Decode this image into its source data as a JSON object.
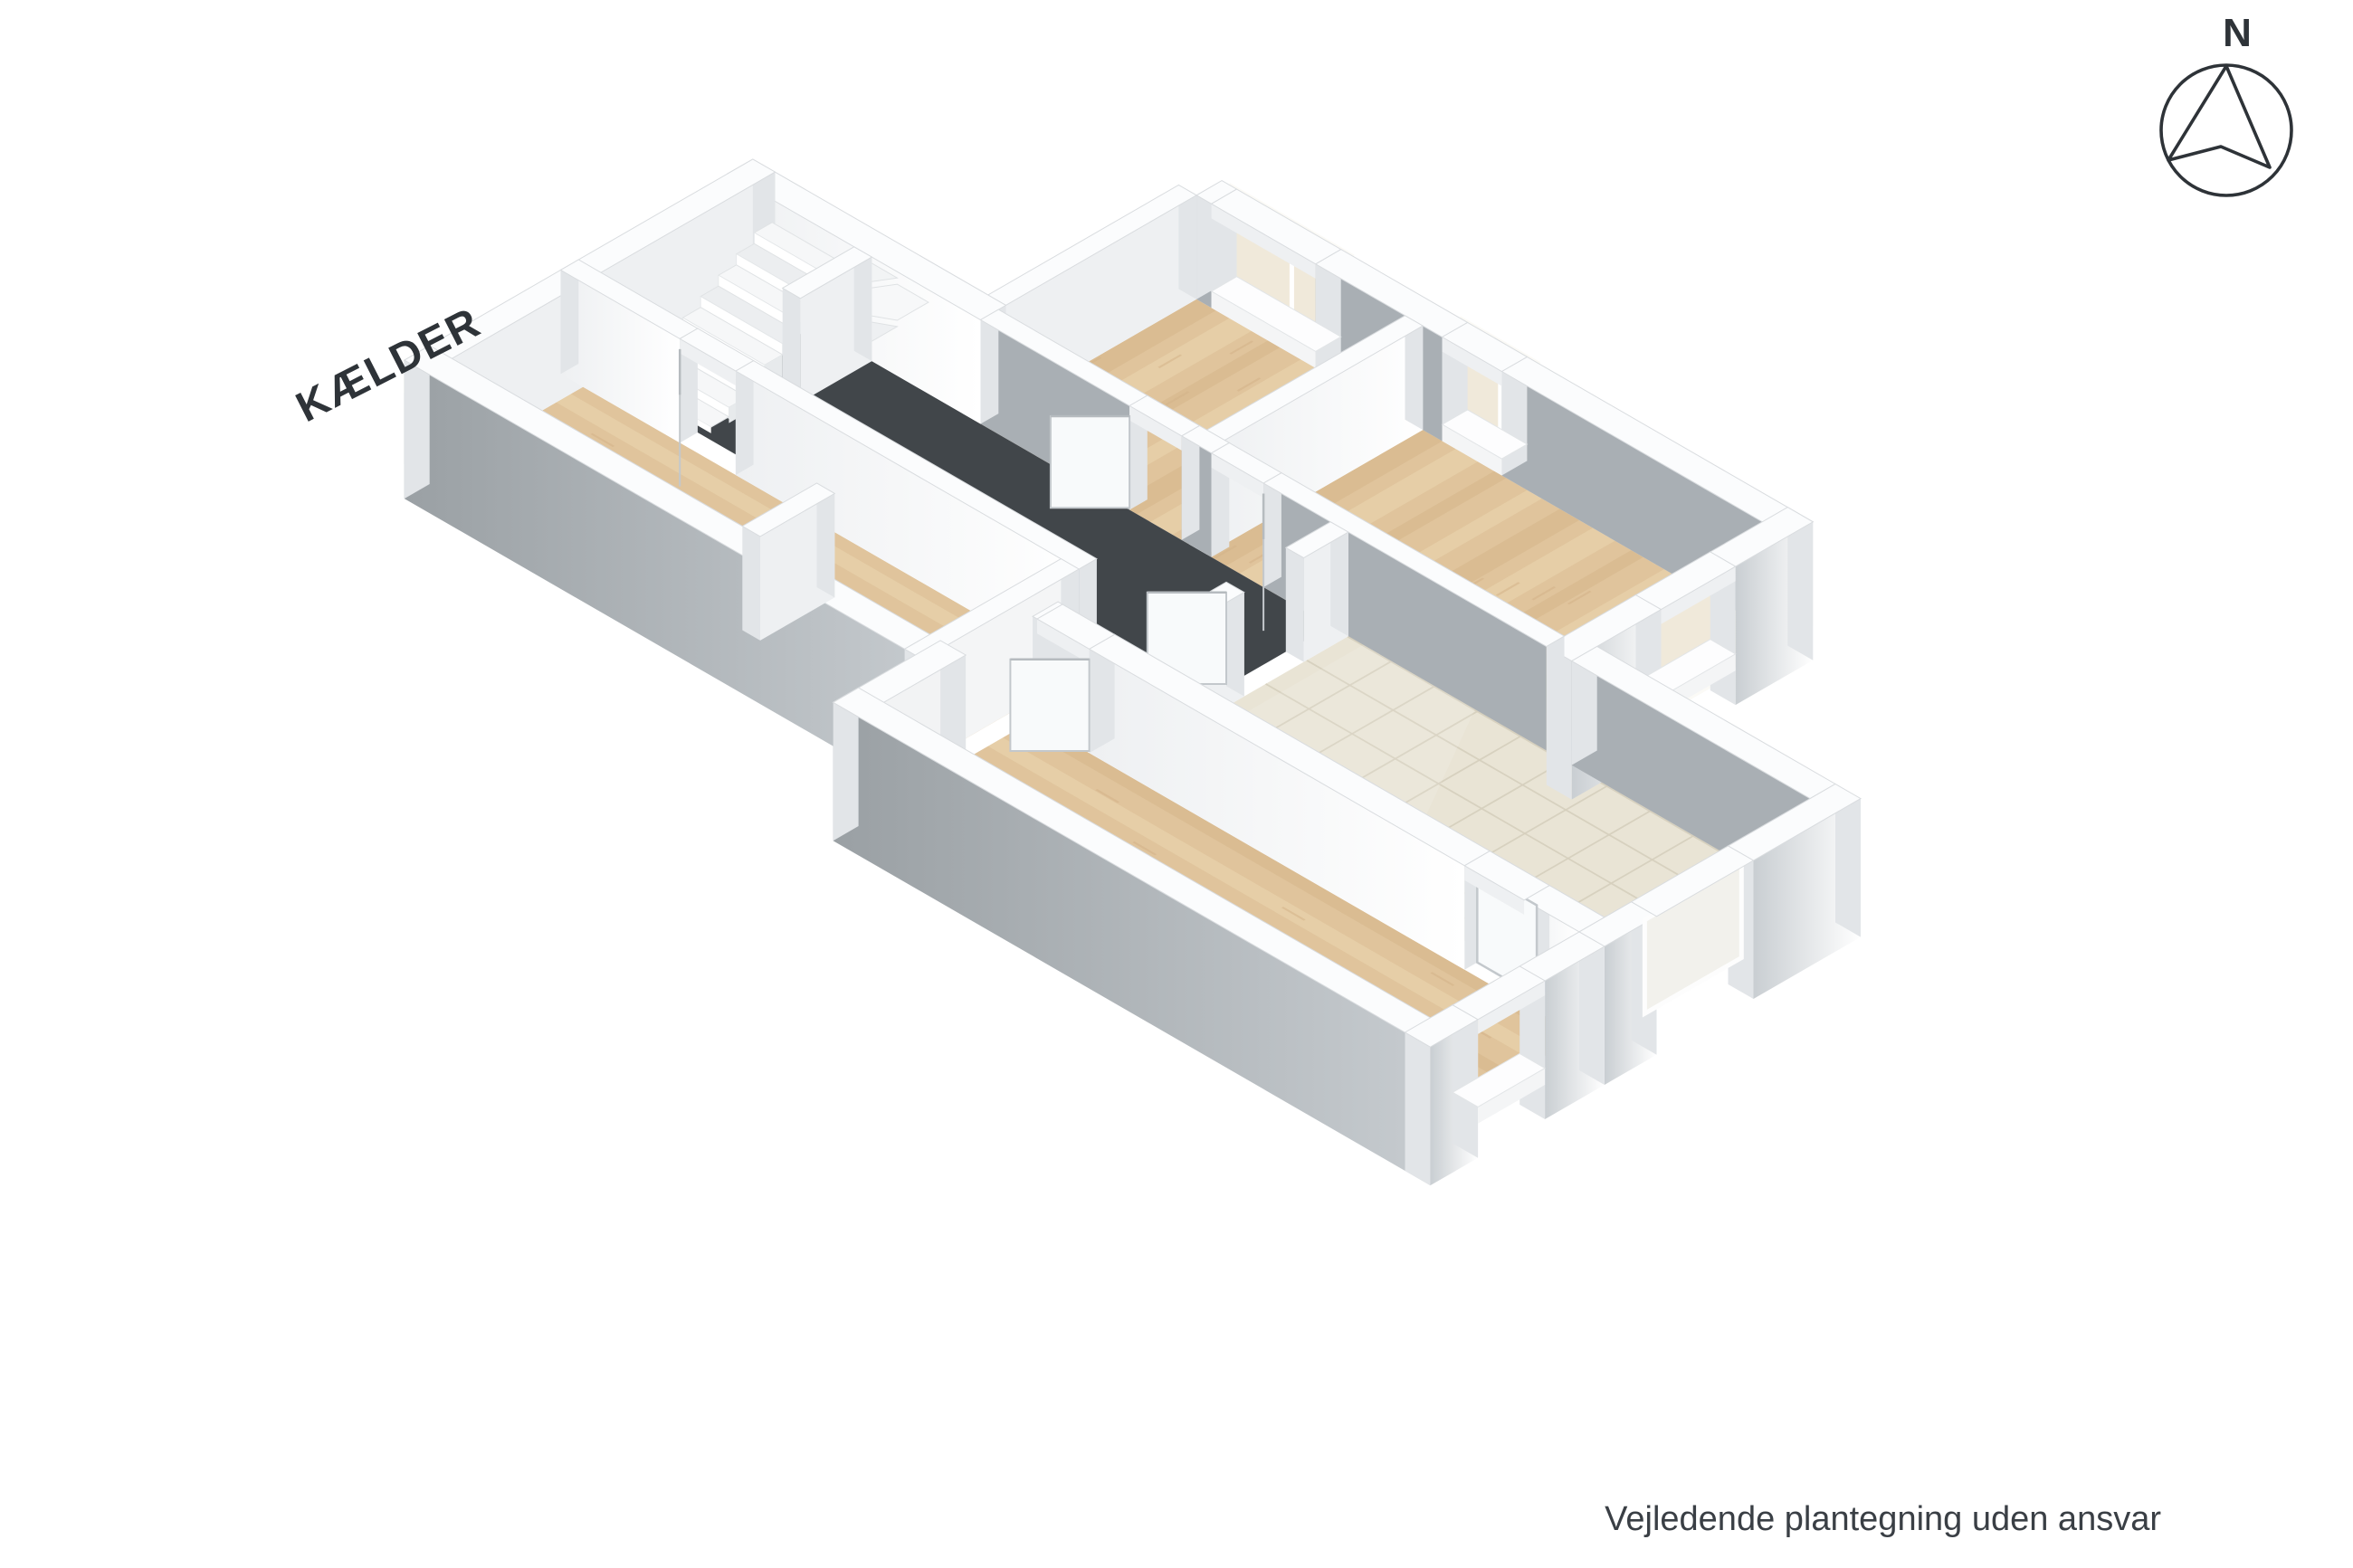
{
  "labels": {
    "floor_title": "KÆLDER",
    "compass_north": "N",
    "disclaimer": "Vejledende plantegning uden ansvar"
  },
  "icons": {
    "compass": "compass-rose-icon"
  },
  "colors": {
    "ink": "#2e3338",
    "text": "#3a3f45",
    "wall_top": "#fbfcfd",
    "wall_edge": "#d9dcdf",
    "face_bright": "#ffffff",
    "face_light": "#eef0f2",
    "face_mid": "#c9ced2",
    "face_gray": "#a9afb4",
    "cap": "#e2e5e8",
    "floor_dark": "#41464a",
    "wood_base": "#e0c49c",
    "wood_dark": "#d4b388",
    "wood_light": "#ecd7b2",
    "tile_base": "#e9e4d5",
    "tile_grout": "#d6cfbd",
    "shade": "#f0e9da",
    "door": "#f8fafb",
    "door_edge": "#c3c8cc",
    "basin": "#b4b9bd"
  }
}
